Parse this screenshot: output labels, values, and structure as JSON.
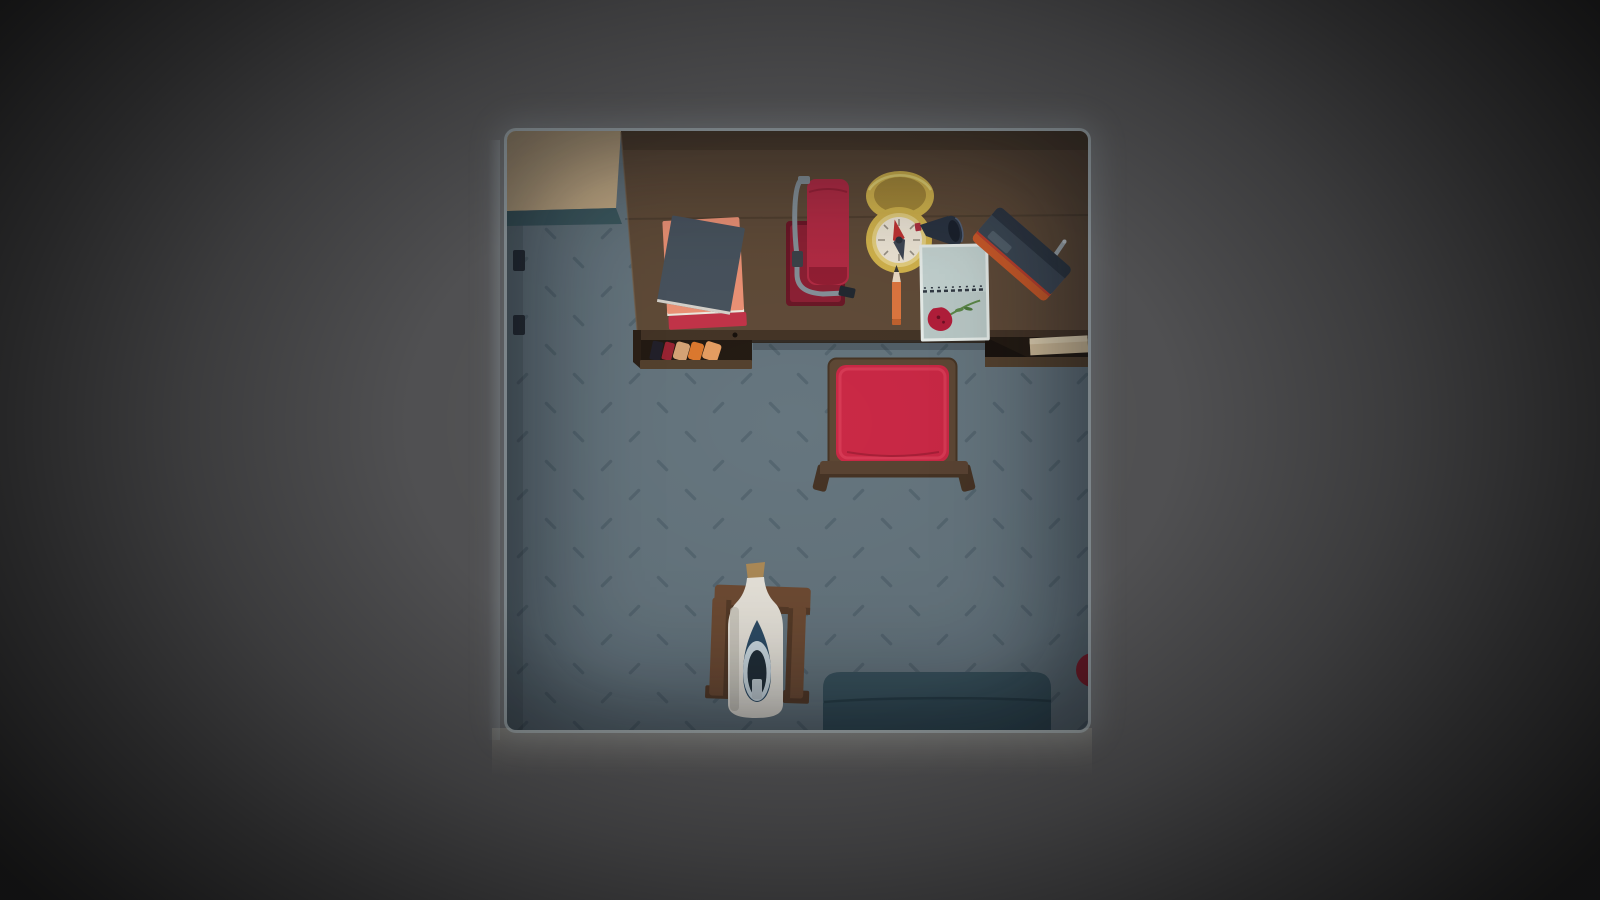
{
  "meta": {
    "type": "game-scene",
    "view": "top-down-room",
    "description": "Top-down view of a small room framed by a dark vignette: wooden desk with items along the top wall, red cushioned chair, corked bottle on a wooden stand, teal couch at the bottom, beige rug in the top-left corner."
  },
  "palette": {
    "floor": "#66767f",
    "floor_dash": "#465864",
    "rug": "#c7ae88",
    "rug_edge": "#3e5a61",
    "wall_hook": "#272e36",
    "desk": "#614c39",
    "desk_back": "#53412f",
    "desk_front_edge": "#453527",
    "desk_shadow": "#2c2118",
    "desk_edge_light": "#7a6148",
    "shelf_interior": "#241b13",
    "shelf_lip": "#55422f",
    "spine_black": "#23212b",
    "spine_red": "#9c2433",
    "spine_tan": "#d8a678",
    "spine_orange": "#df7a2f",
    "spine_salmon": "#e89f63",
    "paper": "#d8c39e",
    "paper_fold": "#e9d9b8",
    "book_salmon": "#ef9477",
    "book_red_edge": "#c5344a",
    "book_dark": "#49545f",
    "book_white_edge": "#f2ece2",
    "extinguisher_base_border": "#6c1827",
    "extinguisher_base": "#8e2135",
    "extinguisher_red": "#b52c45",
    "extinguisher_dark": "#951f35",
    "hose_gray": "#87929a",
    "nozzle_dark": "#232931",
    "compass_gold": "#d5b64e",
    "compass_lid_inner": "#aa8c3a",
    "compass_rim_light": "#ead875",
    "compass_ring": "#e7d181",
    "compass_face": "#f0e8d8",
    "compass_tick": "#9b9386",
    "needle_red": "#c23434",
    "needle_dark": "#3f4754",
    "needle_pin": "#2c323c",
    "horn_navy": "#2b3442",
    "horn_dark": "#1b222d",
    "horn_mouth_red": "#b03040",
    "pencil_orange": "#df7740",
    "pencil_wood": "#eddcc6",
    "pencil_lead": "#3a3a3a",
    "pencil_end": "#c2632f",
    "notebook_edge": "#e9efec",
    "notebook_page": "#c5d4d2",
    "notebook_page_lower": "#bccbc9",
    "spiral_dark": "#323a44",
    "rose_red": "#b51f3c",
    "rose_dark": "#6e1024",
    "rose_stem": "#5d8a4a",
    "rose_leaf": "#4e7a3e",
    "radio_orange": "#cf5c2a",
    "radio_body": "#3e4956",
    "radio_stripe": "#2e3743",
    "radio_panel": "#55626e",
    "radio_red_line": "#c2412e",
    "antenna_gray": "#a7b0b6",
    "chair_frame": "#5e4835",
    "chair_frame_line": "#473525",
    "chair_cushion": "#cb2946",
    "chair_cushion_hi": "#d83a55",
    "chair_cushion_fold": "#a82038",
    "chair_rail": "#5a4433",
    "chair_leg": "#473425",
    "stand_wood": "#6f4c34",
    "stand_dark": "#563b28",
    "cork": "#ae8b58",
    "bottle_body": "#e9e5dc",
    "bottle_shade": "#c6c2b8",
    "bottle_inner_navy": "#2e4d66",
    "bottle_inner_ring": "#cfdde4",
    "bottle_inner_dark": "#222f39",
    "bottle_inner_slot": "#c4cfd5",
    "couch": "#3b5560",
    "couch_dark": "#344e59",
    "couch_seam": "#2a414b",
    "ball_red": "#8e1f2d"
  },
  "scene": {
    "objects": [
      {
        "name": "rug",
        "desc": "beige rug in top-left corner with teal edge strip"
      },
      {
        "name": "wall-hooks",
        "desc": "two dark brackets on the left wall"
      },
      {
        "name": "desk",
        "desc": "wooden desk spanning the top wall"
      },
      {
        "name": "desk-shelf-books",
        "desc": "leaning books in the under-desk shelf"
      },
      {
        "name": "folded-paper",
        "desc": "folded beige paper in the right under-desk shelf"
      },
      {
        "name": "book-stack",
        "desc": "dark book on top of a salmon book with red edge"
      },
      {
        "name": "fire-extinguisher",
        "desc": "red extinguisher on a dark red wall plate with gray hose"
      },
      {
        "name": "pocket-compass",
        "desc": "open gold pocket compass with red needle"
      },
      {
        "name": "horn",
        "desc": "small dark horn beside the compass"
      },
      {
        "name": "pencil",
        "desc": "orange pencil, tip pointing up"
      },
      {
        "name": "notebook-with-rose",
        "desc": "open spiral notebook with a red rose on the lower page"
      },
      {
        "name": "radio",
        "desc": "orange and slate portable radio with antenna, tilted"
      },
      {
        "name": "chair",
        "desc": "square red cushioned chair with wooden frame"
      },
      {
        "name": "ship-bottle",
        "desc": "corked cream bottle on a wooden stand"
      },
      {
        "name": "couch",
        "desc": "dark teal couch at the bottom edge"
      },
      {
        "name": "red-ball",
        "desc": "red ball tucked against the right wall"
      }
    ]
  }
}
